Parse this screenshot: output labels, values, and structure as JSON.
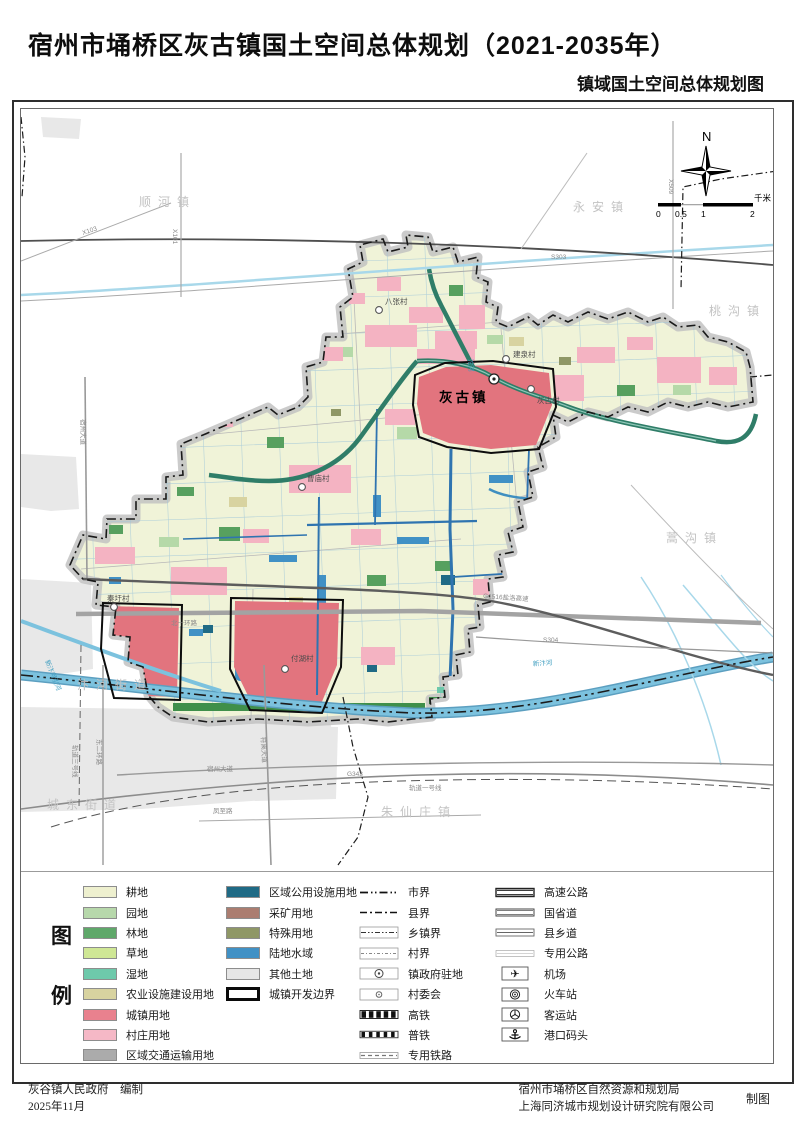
{
  "title": "宿州市埇桥区灰古镇国土空间总体规划（2021-2035年）",
  "subtitle": "镇域国土空间总体规划图",
  "compass": {
    "north_label": "N"
  },
  "scale_bar": {
    "ticks": [
      "0",
      "0.5",
      "1",
      "2"
    ],
    "unit": "千米"
  },
  "map": {
    "town_label": "灰古镇",
    "neighbors": [
      {
        "label": "顺河镇"
      },
      {
        "label": "永安镇"
      },
      {
        "label": "桃沟镇"
      },
      {
        "label": "蒿沟镇"
      },
      {
        "label": "朱仙庄镇"
      },
      {
        "label": "汴河街道"
      },
      {
        "label": "城东街道"
      }
    ],
    "villages": [
      {
        "label": "八张村"
      },
      {
        "label": "建泉村"
      },
      {
        "label": "灰古村"
      },
      {
        "label": "曹庙村"
      },
      {
        "label": "秦圩村"
      },
      {
        "label": "付湖村"
      }
    ],
    "road_labels": [
      {
        "text": "X103"
      },
      {
        "text": "X101"
      },
      {
        "text": "X509"
      },
      {
        "text": "S303"
      },
      {
        "text": "S304"
      },
      {
        "text": "G1516盐洛高速"
      },
      {
        "text": "G343"
      },
      {
        "text": "轨道一号线"
      },
      {
        "text": "轨道三号线"
      },
      {
        "text": "宿州大道"
      },
      {
        "text": "宿州大道"
      },
      {
        "text": "符离大道"
      },
      {
        "text": "凤至路"
      },
      {
        "text": "东二环路"
      },
      {
        "text": "北十环路"
      }
    ],
    "river_labels": [
      {
        "text": "新汴河"
      },
      {
        "text": "新汴河引河"
      },
      {
        "text": "沱河"
      }
    ]
  },
  "legend": {
    "title_chars": [
      "图",
      "例"
    ],
    "land_use_col1": [
      {
        "label": "耕地",
        "color": "#eef0cf"
      },
      {
        "label": "园地",
        "color": "#b7d8ab"
      },
      {
        "label": "林地",
        "color": "#5fa86a"
      },
      {
        "label": "草地",
        "color": "#cfe795"
      },
      {
        "label": "湿地",
        "color": "#6ec9ab"
      },
      {
        "label": "农业设施建设用地",
        "color": "#d8d3a0"
      },
      {
        "label": "城镇用地",
        "color": "#e9818e"
      },
      {
        "label": "村庄用地",
        "color": "#f5b8c6"
      },
      {
        "label": "区域交通运输用地",
        "color": "#ababab"
      }
    ],
    "land_use_col2": [
      {
        "label": "区域公用设施用地",
        "color": "#1f6a85"
      },
      {
        "label": "采矿用地",
        "color": "#ab7d70"
      },
      {
        "label": "特殊用地",
        "color": "#8f9766"
      },
      {
        "label": "陆地水域",
        "color": "#4191c5"
      },
      {
        "label": "其他土地",
        "color": "#e6e6e6"
      },
      {
        "label": "城镇开发边界",
        "outline": true
      }
    ],
    "boundary_items": [
      {
        "label": "市界",
        "sym": "city-boundary"
      },
      {
        "label": "县界",
        "sym": "county-boundary"
      },
      {
        "label": "乡镇界",
        "sym": "township-boundary"
      },
      {
        "label": "村界",
        "sym": "village-boundary"
      },
      {
        "label": "镇政府驻地",
        "sym": "town-government-seat"
      },
      {
        "label": "村委会",
        "sym": "village-committee"
      },
      {
        "label": "高铁",
        "sym": "high-speed-rail"
      },
      {
        "label": "普铁",
        "sym": "regular-rail"
      },
      {
        "label": "专用铁路",
        "sym": "dedicated-rail"
      }
    ],
    "facility_items": [
      {
        "label": "高速公路",
        "sym": "expressway"
      },
      {
        "label": "国省道",
        "sym": "national-provincial-road"
      },
      {
        "label": "县乡道",
        "sym": "county-township-road"
      },
      {
        "label": "专用公路",
        "sym": "dedicated-road"
      },
      {
        "label": "机场",
        "sym": "airport"
      },
      {
        "label": "火车站",
        "sym": "railway-station"
      },
      {
        "label": "客运站",
        "sym": "bus-station"
      },
      {
        "label": "港口码头",
        "sym": "port-wharf"
      }
    ]
  },
  "footer": {
    "prepared_by": "灰谷镇人民政府　编制",
    "date": "2025年11月",
    "org1": "宿州市埇桥区自然资源和规划局",
    "org2": "上海同济城市规划设计研究院有限公司",
    "drafting": "制图"
  },
  "colors": {
    "territory_fill": "#f0f3d8",
    "urban_red": "#e2747e",
    "village_pink": "#f4b3c2",
    "water_blue": "#4191c5",
    "river_teal": "#2f7d68",
    "boundary_black": "#1a1a1a"
  }
}
